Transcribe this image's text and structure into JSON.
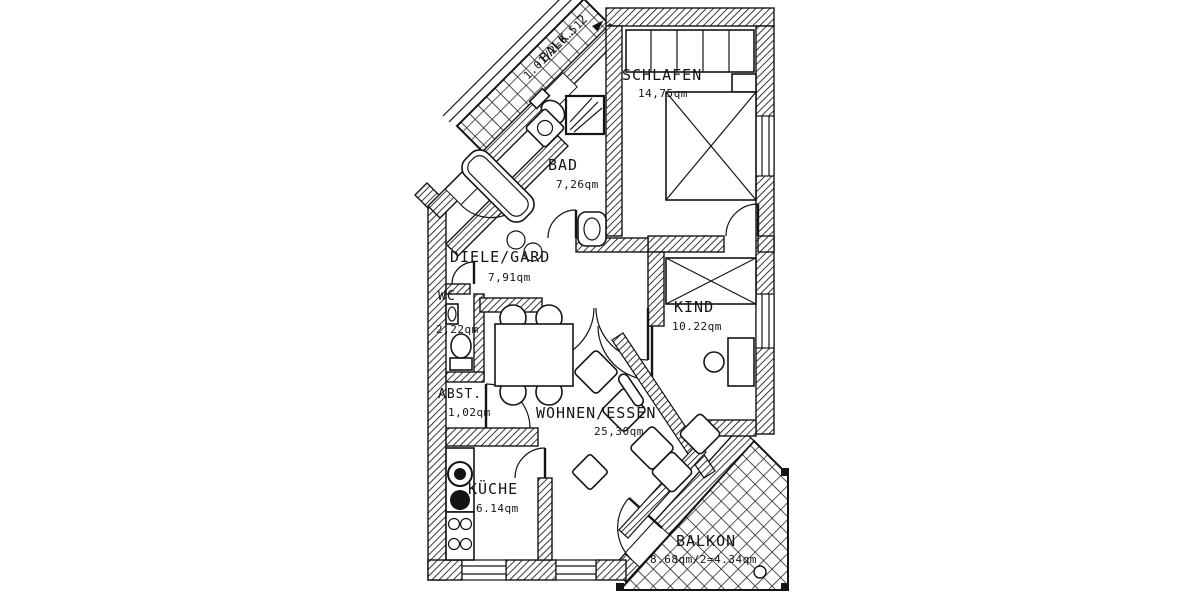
{
  "plan": {
    "colors": {
      "ink": "#141414",
      "paper": "#ffffff"
    },
    "units_note": "qm",
    "rooms": {
      "balk2": {
        "name": "BALK. 2",
        "area": "1.01/2=0.51"
      },
      "schlafen": {
        "name": "SCHLAFEN",
        "area": "14,75qm"
      },
      "bad": {
        "name": "BAD",
        "area": "7,26qm"
      },
      "diele": {
        "name": "DIELE/GARD",
        "area": "7,91qm"
      },
      "wc": {
        "name": "WC",
        "area": "2,22qm"
      },
      "kind": {
        "name": "KIND",
        "area": "10.22qm"
      },
      "abst": {
        "name": "ABST.",
        "area": "1,02qm"
      },
      "wohnen": {
        "name": "WOHNEN/ESSEN",
        "area": "25,30qm"
      },
      "kueche": {
        "name": "KÜCHE",
        "area": "6.14qm"
      },
      "balkon": {
        "name": "BALKON",
        "area": "8.68qm/2=4.34qm"
      }
    }
  }
}
